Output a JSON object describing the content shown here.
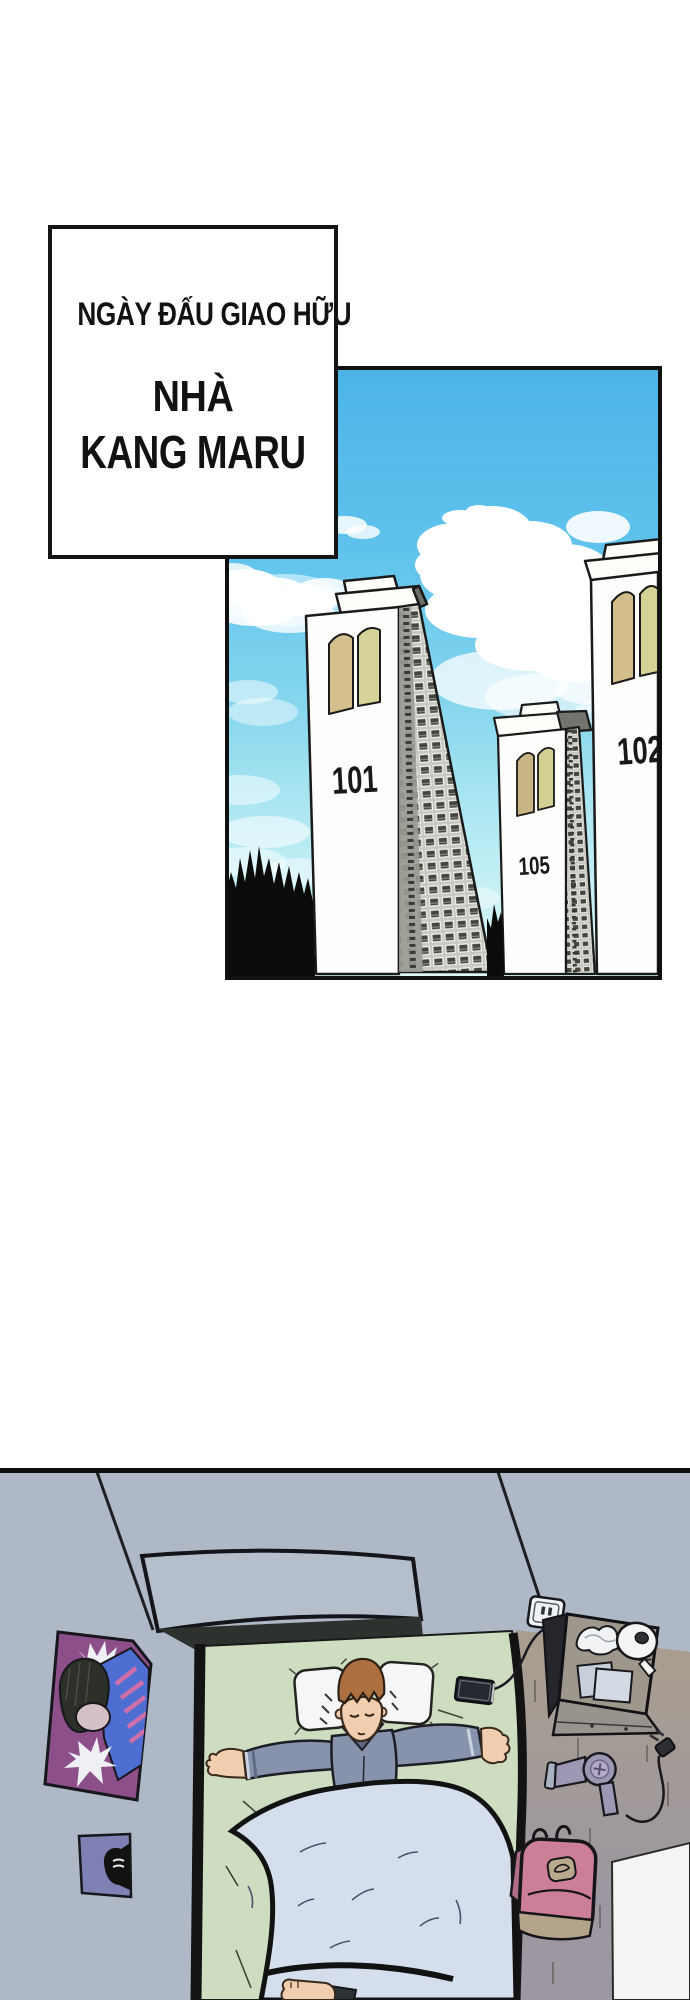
{
  "caption_box": {
    "line1": "NGÀY ĐẤU GIAO HỮU",
    "line2": "NHÀ",
    "line3": "KANG MARU"
  },
  "city_panel": {
    "building_left_number": "101",
    "building_middle_number": "105",
    "building_right_number": "102"
  },
  "palette": {
    "sky_top": "#4db4e8",
    "sky_bottom": "#dff8f6",
    "building_face": "#fefefc",
    "door_tan": "#d5bf8c",
    "door_green": "#d6d399",
    "tree_silhouette": "#0b0b09",
    "room_wall": "#aeb8c6",
    "bed_sheet_green": "#cedcc0",
    "blanket_blue": "#d5deec",
    "pajama_blue": "#8793ad",
    "poster_purple": "#8d4f8a",
    "backpack_pink": "#ce7f98",
    "floor_tan": "#a89d8f",
    "floor_grey": "#9c97a1"
  }
}
